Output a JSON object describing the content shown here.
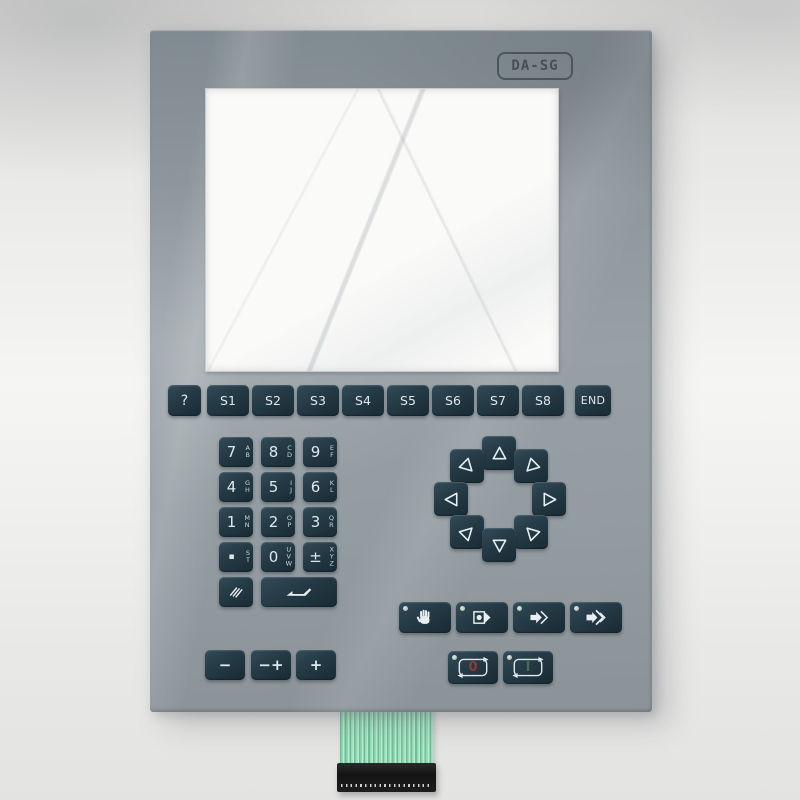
{
  "badge": {
    "label": "DA-SG"
  },
  "function_row": {
    "keys": [
      "?",
      "S1",
      "S2",
      "S3",
      "S4",
      "S5",
      "S6",
      "S7",
      "S8",
      "END"
    ]
  },
  "numpad": {
    "keys": [
      {
        "main": "7",
        "letters": [
          "A",
          "B"
        ]
      },
      {
        "main": "8",
        "letters": [
          "C",
          "D"
        ]
      },
      {
        "main": "9",
        "letters": [
          "E",
          "F"
        ]
      },
      {
        "main": "4",
        "letters": [
          "G",
          "H"
        ]
      },
      {
        "main": "5",
        "letters": [
          "I",
          "J"
        ]
      },
      {
        "main": "6",
        "letters": [
          "K",
          "L"
        ]
      },
      {
        "main": "1",
        "letters": [
          "M",
          "N"
        ]
      },
      {
        "main": "2",
        "letters": [
          "O",
          "P"
        ]
      },
      {
        "main": "3",
        "letters": [
          "Q",
          "R"
        ]
      },
      {
        "main": "▪",
        "letters": [
          "S",
          "T"
        ]
      },
      {
        "main": "0",
        "letters": [
          "U",
          "V",
          "W"
        ]
      },
      {
        "main": "±",
        "letters": [
          "X",
          "Y",
          "Z"
        ]
      }
    ],
    "clear_icon": "correction-slashes-icon",
    "enter_icon": "enter-return-icon"
  },
  "arrow_pad": {
    "layout": "8-way circle",
    "keys": [
      {
        "position": "up",
        "points": "up"
      },
      {
        "position": "up-left",
        "points": "down-right"
      },
      {
        "position": "up-right",
        "points": "down-left"
      },
      {
        "position": "left",
        "points": "left"
      },
      {
        "position": "right",
        "points": "right"
      },
      {
        "position": "down-left",
        "points": "up-right"
      },
      {
        "position": "down-right",
        "points": "up-left"
      },
      {
        "position": "down",
        "points": "down"
      }
    ]
  },
  "special_row": {
    "keys": [
      {
        "icon": "hand-icon",
        "led": true
      },
      {
        "icon": "screen-advance-icon",
        "led": true
      },
      {
        "icon": "arrow-advance-icon",
        "led": true
      },
      {
        "icon": "arrow-skip-icon",
        "led": true
      }
    ]
  },
  "power_row": {
    "keys": [
      {
        "symbol": "0",
        "led": true
      },
      {
        "symbol": "I",
        "led": true
      }
    ]
  },
  "adjust_row": {
    "keys": [
      "−",
      "−+",
      "+"
    ]
  },
  "colors": {
    "panel_gray": "#939ca1",
    "key_dark": "#22363f",
    "key_text": "#dde8ec",
    "power_off_red": "#8f3a35",
    "power_on_green": "#4a6b52",
    "led_dot": "#ccd4cd",
    "ribbon_green": "#8fd3ac",
    "connector_black": "#171717",
    "screen_white": "#fafaf8"
  }
}
